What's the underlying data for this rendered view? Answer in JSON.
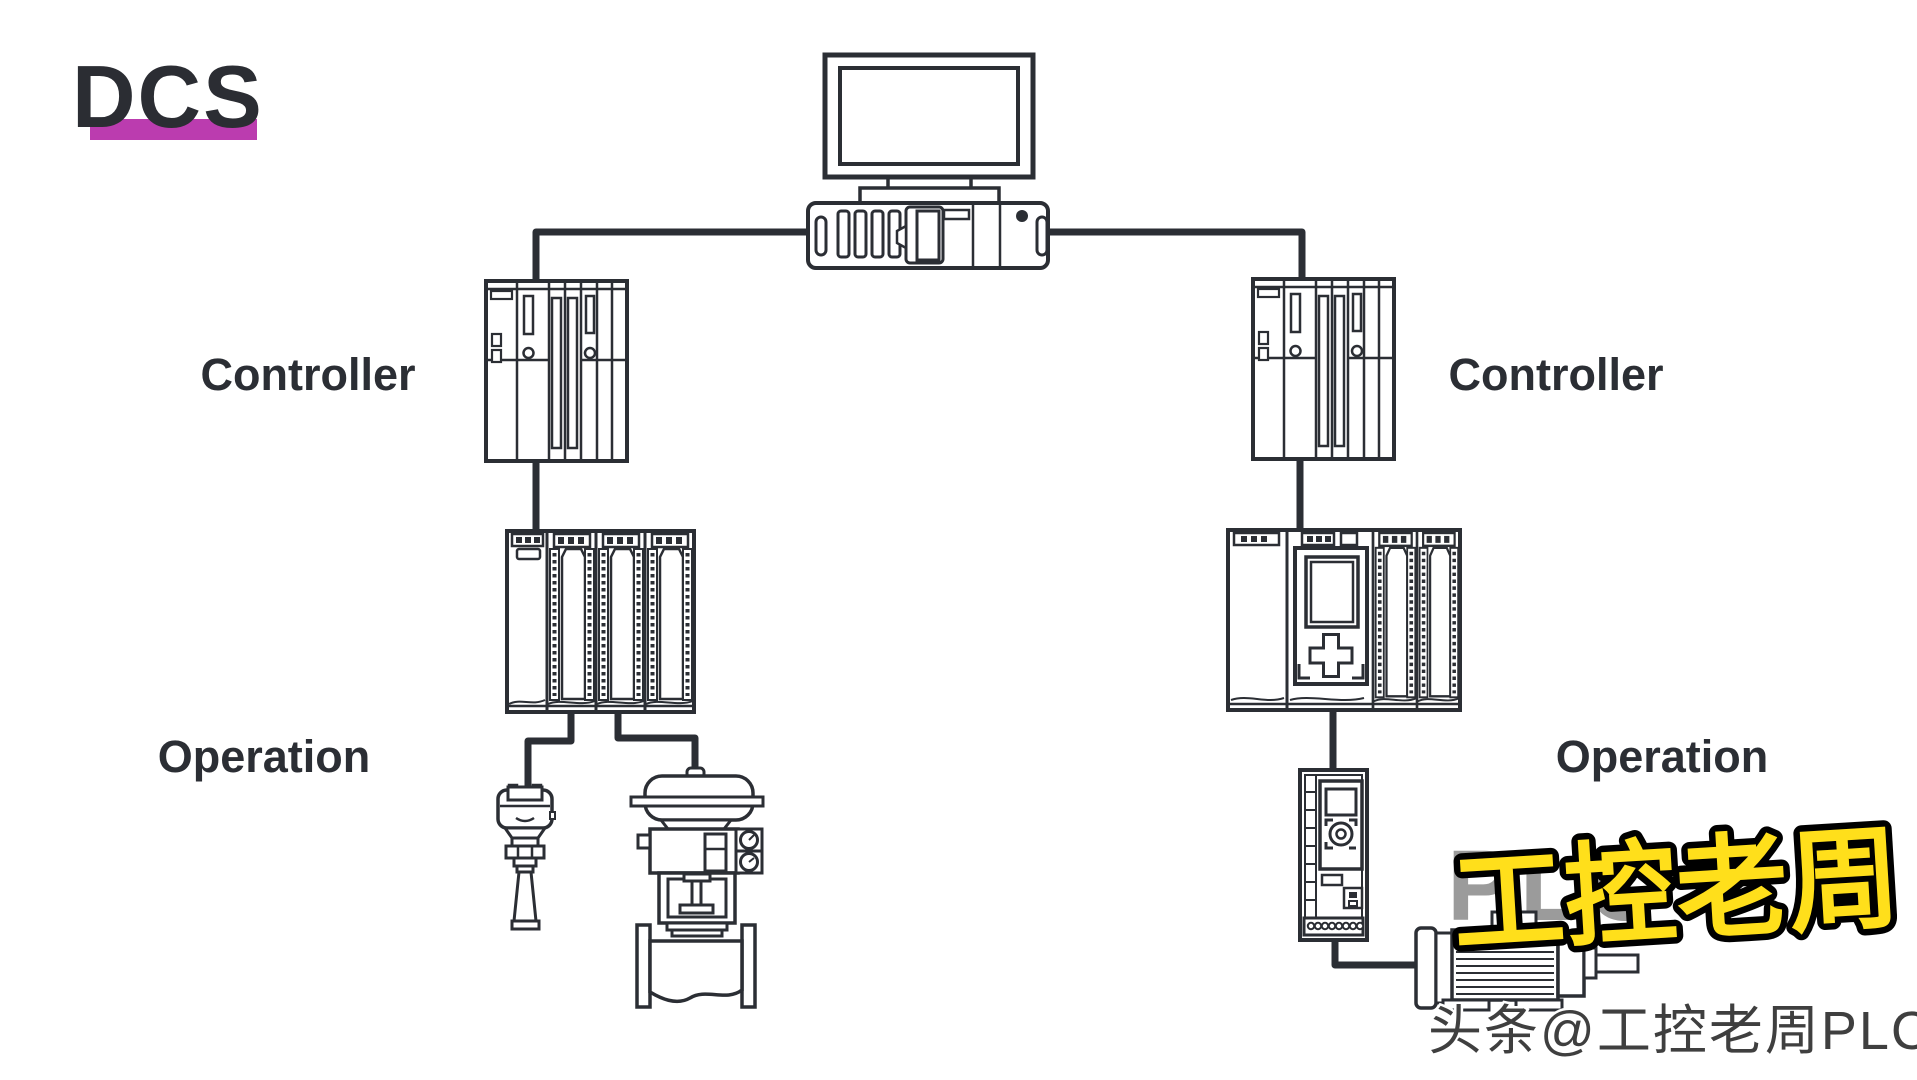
{
  "colors": {
    "background": "#ffffff",
    "line": "#2b2e34",
    "accent_underline": "#bb3caf",
    "watermark_yellow": "#ffdf1b",
    "watermark_ghost_grey": "#9b9b9b",
    "watermark_footer_grey": "#3f3f3f"
  },
  "title": {
    "text": "DCS"
  },
  "labels": {
    "controller_left": "Controller",
    "controller_right": "Controller",
    "operation_left": "Operation",
    "operation_right": "Operation"
  },
  "watermarks": {
    "ghost": "PLC",
    "main": "工控老周",
    "footer": "头条@工控老周PLC"
  },
  "devices": {
    "monitor": "operator-workstation-monitor-icon",
    "server": "dcs-server-icon",
    "controller_left": "plc-controller-rack-icon",
    "controller_right": "plc-controller-rack-icon",
    "io_rack_left": "remote-io-rack-icon",
    "plc_rack_right": "plc-io-rack-icon",
    "transmitter": "level-transmitter-icon",
    "valve": "control-valve-icon",
    "vfd": "variable-frequency-drive-icon",
    "motor": "electric-motor-icon"
  }
}
